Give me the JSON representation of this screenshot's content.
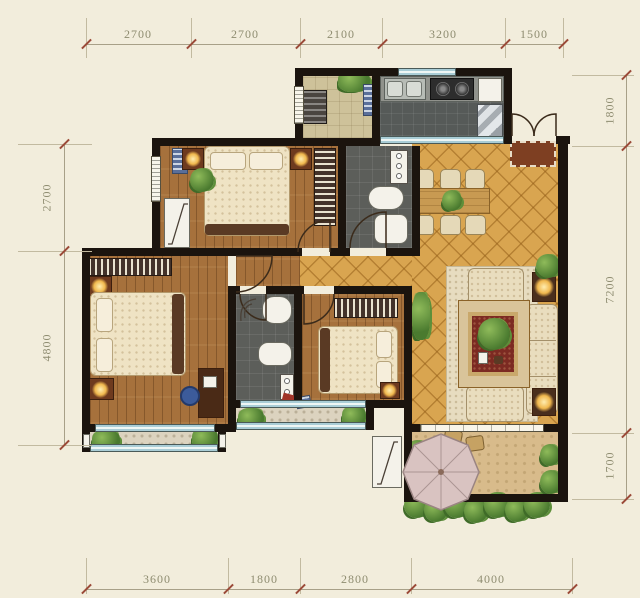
{
  "title": "apartment-floor-plan",
  "dimensions": {
    "top": [
      "2700",
      "2700",
      "2100",
      "3200",
      "1500"
    ],
    "bottom": [
      "3600",
      "1800",
      "2800",
      "4000"
    ],
    "left": [
      "2700",
      "4800"
    ],
    "right": [
      "1800",
      "7200",
      "1700"
    ]
  },
  "palette": {
    "background": "#f2eddc",
    "wall": "#1b140e",
    "wood_floor": "#a6713c",
    "tile_floor": "#d9a550",
    "bath_floor": "#5c5e5a",
    "kitchen_floor": "#565a58",
    "utility_floor": "#cec29a",
    "balcony_floor": "#dcd3bf",
    "terrace_floor": "#d8bb8b",
    "glazing": "#a9cdd6",
    "dimension_text": "#8e8c70",
    "tick_accent": "#9b4a38",
    "doormat": "#7e3f22",
    "living_rug": "#7c2a22",
    "lamp_glow": "#f0b84e",
    "plant": "#4a7a2f",
    "parasol": "#d9c3c1"
  }
}
